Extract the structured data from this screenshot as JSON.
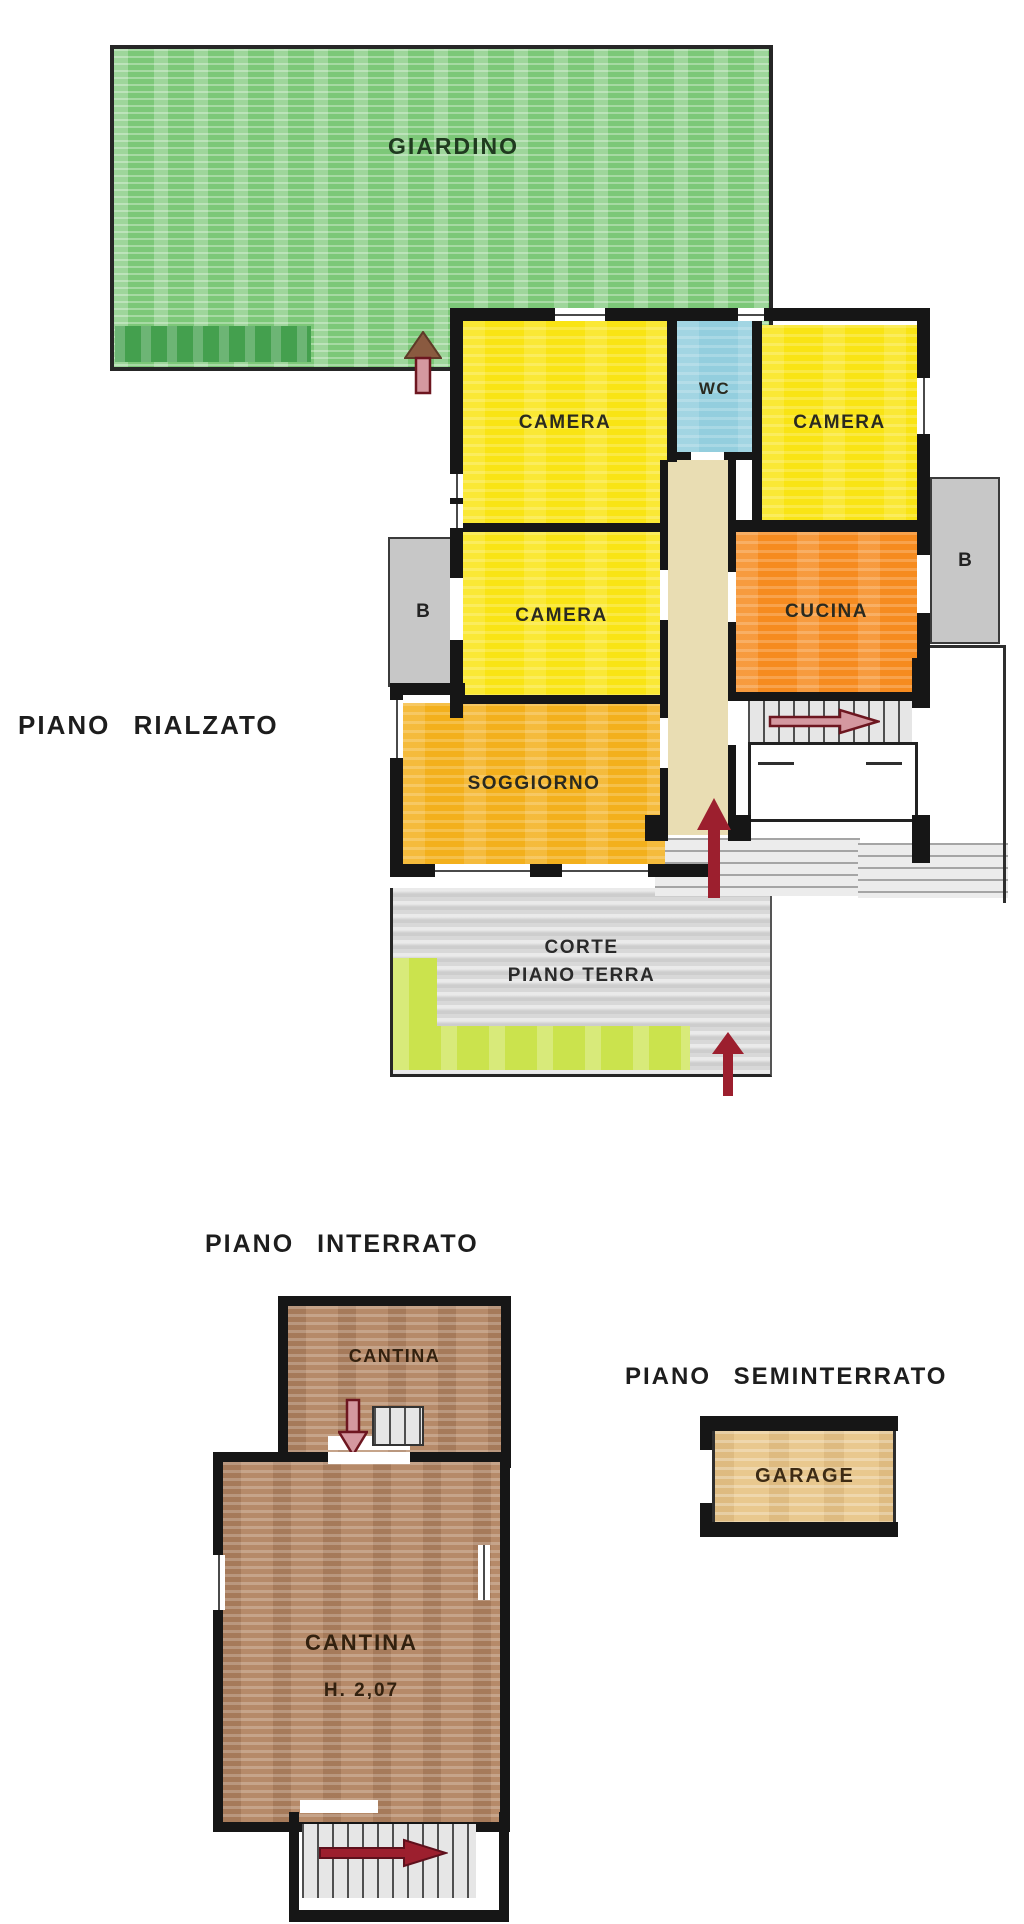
{
  "titles": {
    "rialzato": "PIANO RIALZATO",
    "interrato": "PIANO INTERRATO",
    "seminterrato": "PIANO SEMINTERRATO"
  },
  "garden": {
    "label": "GIARDINO"
  },
  "floor_plan": {
    "camera_top_left": "CAMERA",
    "wc": "WC",
    "camera_top_right": "CAMERA",
    "camera_mid": "CAMERA",
    "cucina": "CUCINA",
    "soggiorno": "SOGGIORNO",
    "balcony_left": "B",
    "balcony_right": "B",
    "corte_line1": "CORTE",
    "corte_line2": "PIANO TERRA"
  },
  "basement": {
    "cantina_small": "CANTINA",
    "cantina_main": "CANTINA",
    "cantina_height": "H. 2,07"
  },
  "semibasement": {
    "garage": "GARAGE"
  },
  "colors": {
    "wall": "#161616",
    "ink": "#2a2a20",
    "garden-green": "#7cc878",
    "hedge-green": "#44a04e",
    "room-yellow": "#f9e414",
    "wc-blue": "#93cede",
    "kitchen-orange": "#f68b1f",
    "living-gold": "#f3b01c",
    "corridor-beige": "#e9ddb3",
    "balcony-gray": "#c7c7c7",
    "court-gray": "#d8d8d8",
    "lime-green": "#cbe34d",
    "cellar-brown": "#b68a69",
    "garage-wheat": "#e9c88e",
    "arrow-red": "#9c1f2e",
    "arrow-pink": "#d498a0"
  }
}
